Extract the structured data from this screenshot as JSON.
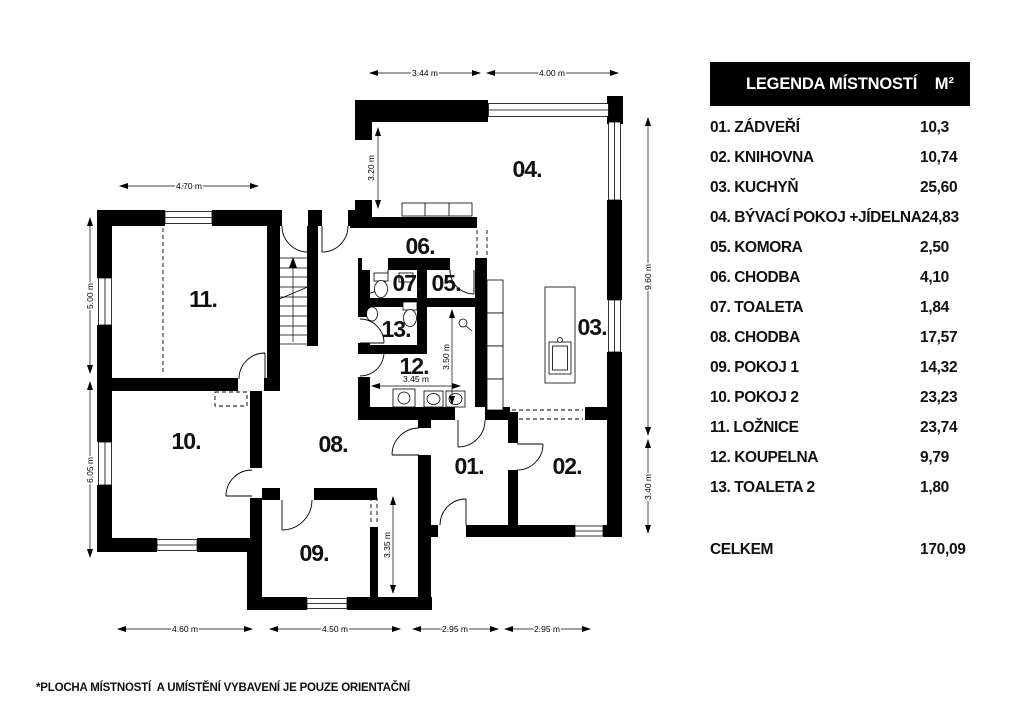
{
  "legend": {
    "title": "LEGENDA MÍSTNOSTÍ",
    "unit": "M²",
    "rows": [
      {
        "name": "01. ZÁDVEŘÍ",
        "area": "10,3"
      },
      {
        "name": "02. KNIHOVNA",
        "area": "10,74"
      },
      {
        "name": "03. KUCHYŇ",
        "area": "25,60"
      },
      {
        "name": "04. BÝVACÍ POKOJ +JÍDELNA",
        "area": "24,83"
      },
      {
        "name": "05. KOMORA",
        "area": "2,50"
      },
      {
        "name": "06. CHODBA",
        "area": "4,10"
      },
      {
        "name": "07. TOALETA",
        "area": "1,84"
      },
      {
        "name": "08. CHODBA",
        "area": "17,57"
      },
      {
        "name": "09. POKOJ 1",
        "area": "14,32"
      },
      {
        "name": "10. POKOJ 2",
        "area": "23,23"
      },
      {
        "name": "11. LOŽNICE",
        "area": "23,74"
      },
      {
        "name": "12. KOUPELNA",
        "area": "9,79"
      },
      {
        "name": "13. TOALETA 2",
        "area": "1,80"
      }
    ],
    "total_label": "CELKEM",
    "total_value": "170,09"
  },
  "plan": {
    "rooms": [
      {
        "id": "01",
        "label": "01."
      },
      {
        "id": "02",
        "label": "02."
      },
      {
        "id": "03",
        "label": "03."
      },
      {
        "id": "04",
        "label": "04."
      },
      {
        "id": "05",
        "label": "05."
      },
      {
        "id": "06",
        "label": "06."
      },
      {
        "id": "07",
        "label": "07."
      },
      {
        "id": "08",
        "label": "08."
      },
      {
        "id": "09",
        "label": "09."
      },
      {
        "id": "10",
        "label": "10."
      },
      {
        "id": "11",
        "label": "11."
      },
      {
        "id": "12",
        "label": "12."
      },
      {
        "id": "13",
        "label": "13."
      }
    ],
    "dims": [
      "3.44 m",
      "4.00 m",
      "4.70 m",
      "5.00 m",
      "6.05 m",
      "9.60 m",
      "3.40 m",
      "4.60 m",
      "4.50 m",
      "2.95 m",
      "2.95 m",
      "3.20 m",
      "3.45 m",
      "3.50 m",
      "3.35 m"
    ]
  },
  "footnote": "*PLOCHA MÍSTNOSTÍ  A UMÍSTĚNÍ VYBAVENÍ JE POUZE ORIENTAČNÍ"
}
